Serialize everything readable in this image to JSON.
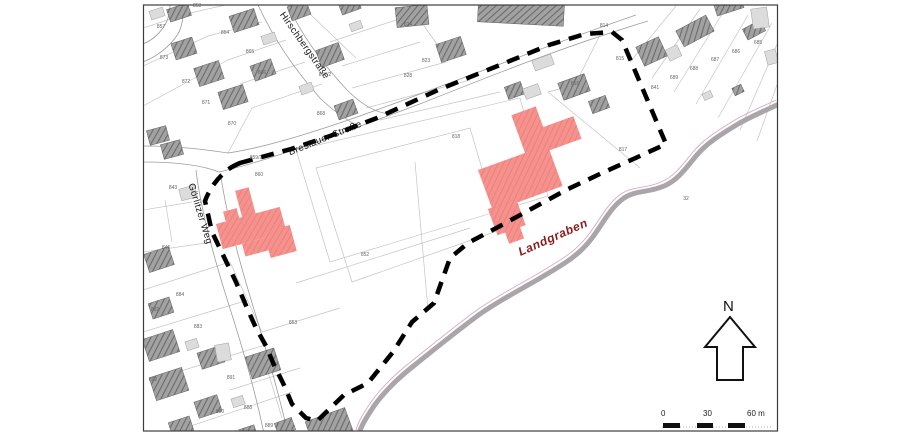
{
  "streets": [
    {
      "label": "Hirschbergstraße"
    },
    {
      "label": "Breslauer Straße"
    },
    {
      "label": "Görlitzer Weg"
    }
  ],
  "waterway": {
    "label": "Landgraben"
  },
  "compass": {
    "label": "N"
  },
  "scalebar": {
    "tick0": "0",
    "tick1": "30",
    "tick2": "60 m"
  },
  "colors": {
    "highlight_building_fill": "#f5928e",
    "highlight_building_hatch": "#ea7b76",
    "gray_building_fill": "#a2a2a2",
    "gray_building_hatch": "#6b6b6b",
    "light_building_fill": "#dcdcdc",
    "plan_boundary": "#000000",
    "stream": "#a9a5a9",
    "stream_edge_pink": "#dca8c0",
    "waterway_label": "#8b1a1a",
    "parcel_line": "#c4c4c4"
  },
  "parcels": [
    {
      "label": "858",
      "x": 197,
      "y": 6
    },
    {
      "label": "857",
      "x": 161,
      "y": 27
    },
    {
      "label": "864",
      "x": 225,
      "y": 33
    },
    {
      "label": "865",
      "x": 250,
      "y": 52
    },
    {
      "label": "866",
      "x": 262,
      "y": 73
    },
    {
      "label": "867/2",
      "x": 325,
      "y": 75
    },
    {
      "label": "868",
      "x": 321,
      "y": 114
    },
    {
      "label": "873",
      "x": 164,
      "y": 58
    },
    {
      "label": "872",
      "x": 186,
      "y": 82
    },
    {
      "label": "871",
      "x": 206,
      "y": 103
    },
    {
      "label": "870",
      "x": 232,
      "y": 124
    },
    {
      "label": "859/1",
      "x": 256,
      "y": 158
    },
    {
      "label": "860",
      "x": 259,
      "y": 175
    },
    {
      "label": "824",
      "x": 408,
      "y": 25
    },
    {
      "label": "823",
      "x": 426,
      "y": 61
    },
    {
      "label": "828",
      "x": 408,
      "y": 76
    },
    {
      "label": "814",
      "x": 604,
      "y": 26
    },
    {
      "label": "815",
      "x": 620,
      "y": 59
    },
    {
      "label": "816",
      "x": 575,
      "y": 84
    },
    {
      "label": "817",
      "x": 623,
      "y": 150
    },
    {
      "label": "818",
      "x": 456,
      "y": 137
    },
    {
      "label": "841",
      "x": 655,
      "y": 88
    },
    {
      "label": "689",
      "x": 674,
      "y": 78
    },
    {
      "label": "688",
      "x": 694,
      "y": 69
    },
    {
      "label": "687",
      "x": 715,
      "y": 60
    },
    {
      "label": "686",
      "x": 736,
      "y": 52
    },
    {
      "label": "685",
      "x": 758,
      "y": 43
    },
    {
      "label": "852",
      "x": 365,
      "y": 255
    },
    {
      "label": "853",
      "x": 293,
      "y": 323
    },
    {
      "label": "843",
      "x": 173,
      "y": 188
    },
    {
      "label": "846",
      "x": 166,
      "y": 248
    },
    {
      "label": "884",
      "x": 180,
      "y": 295
    },
    {
      "label": "883",
      "x": 198,
      "y": 327
    },
    {
      "label": "882",
      "x": 155,
      "y": 310
    },
    {
      "label": "891",
      "x": 231,
      "y": 378
    },
    {
      "label": "890",
      "x": 220,
      "y": 412
    },
    {
      "label": "888",
      "x": 248,
      "y": 408
    },
    {
      "label": "889",
      "x": 269,
      "y": 426
    },
    {
      "label": "892",
      "x": 153,
      "y": 380
    },
    {
      "label": "32",
      "x": 686,
      "y": 199
    }
  ]
}
